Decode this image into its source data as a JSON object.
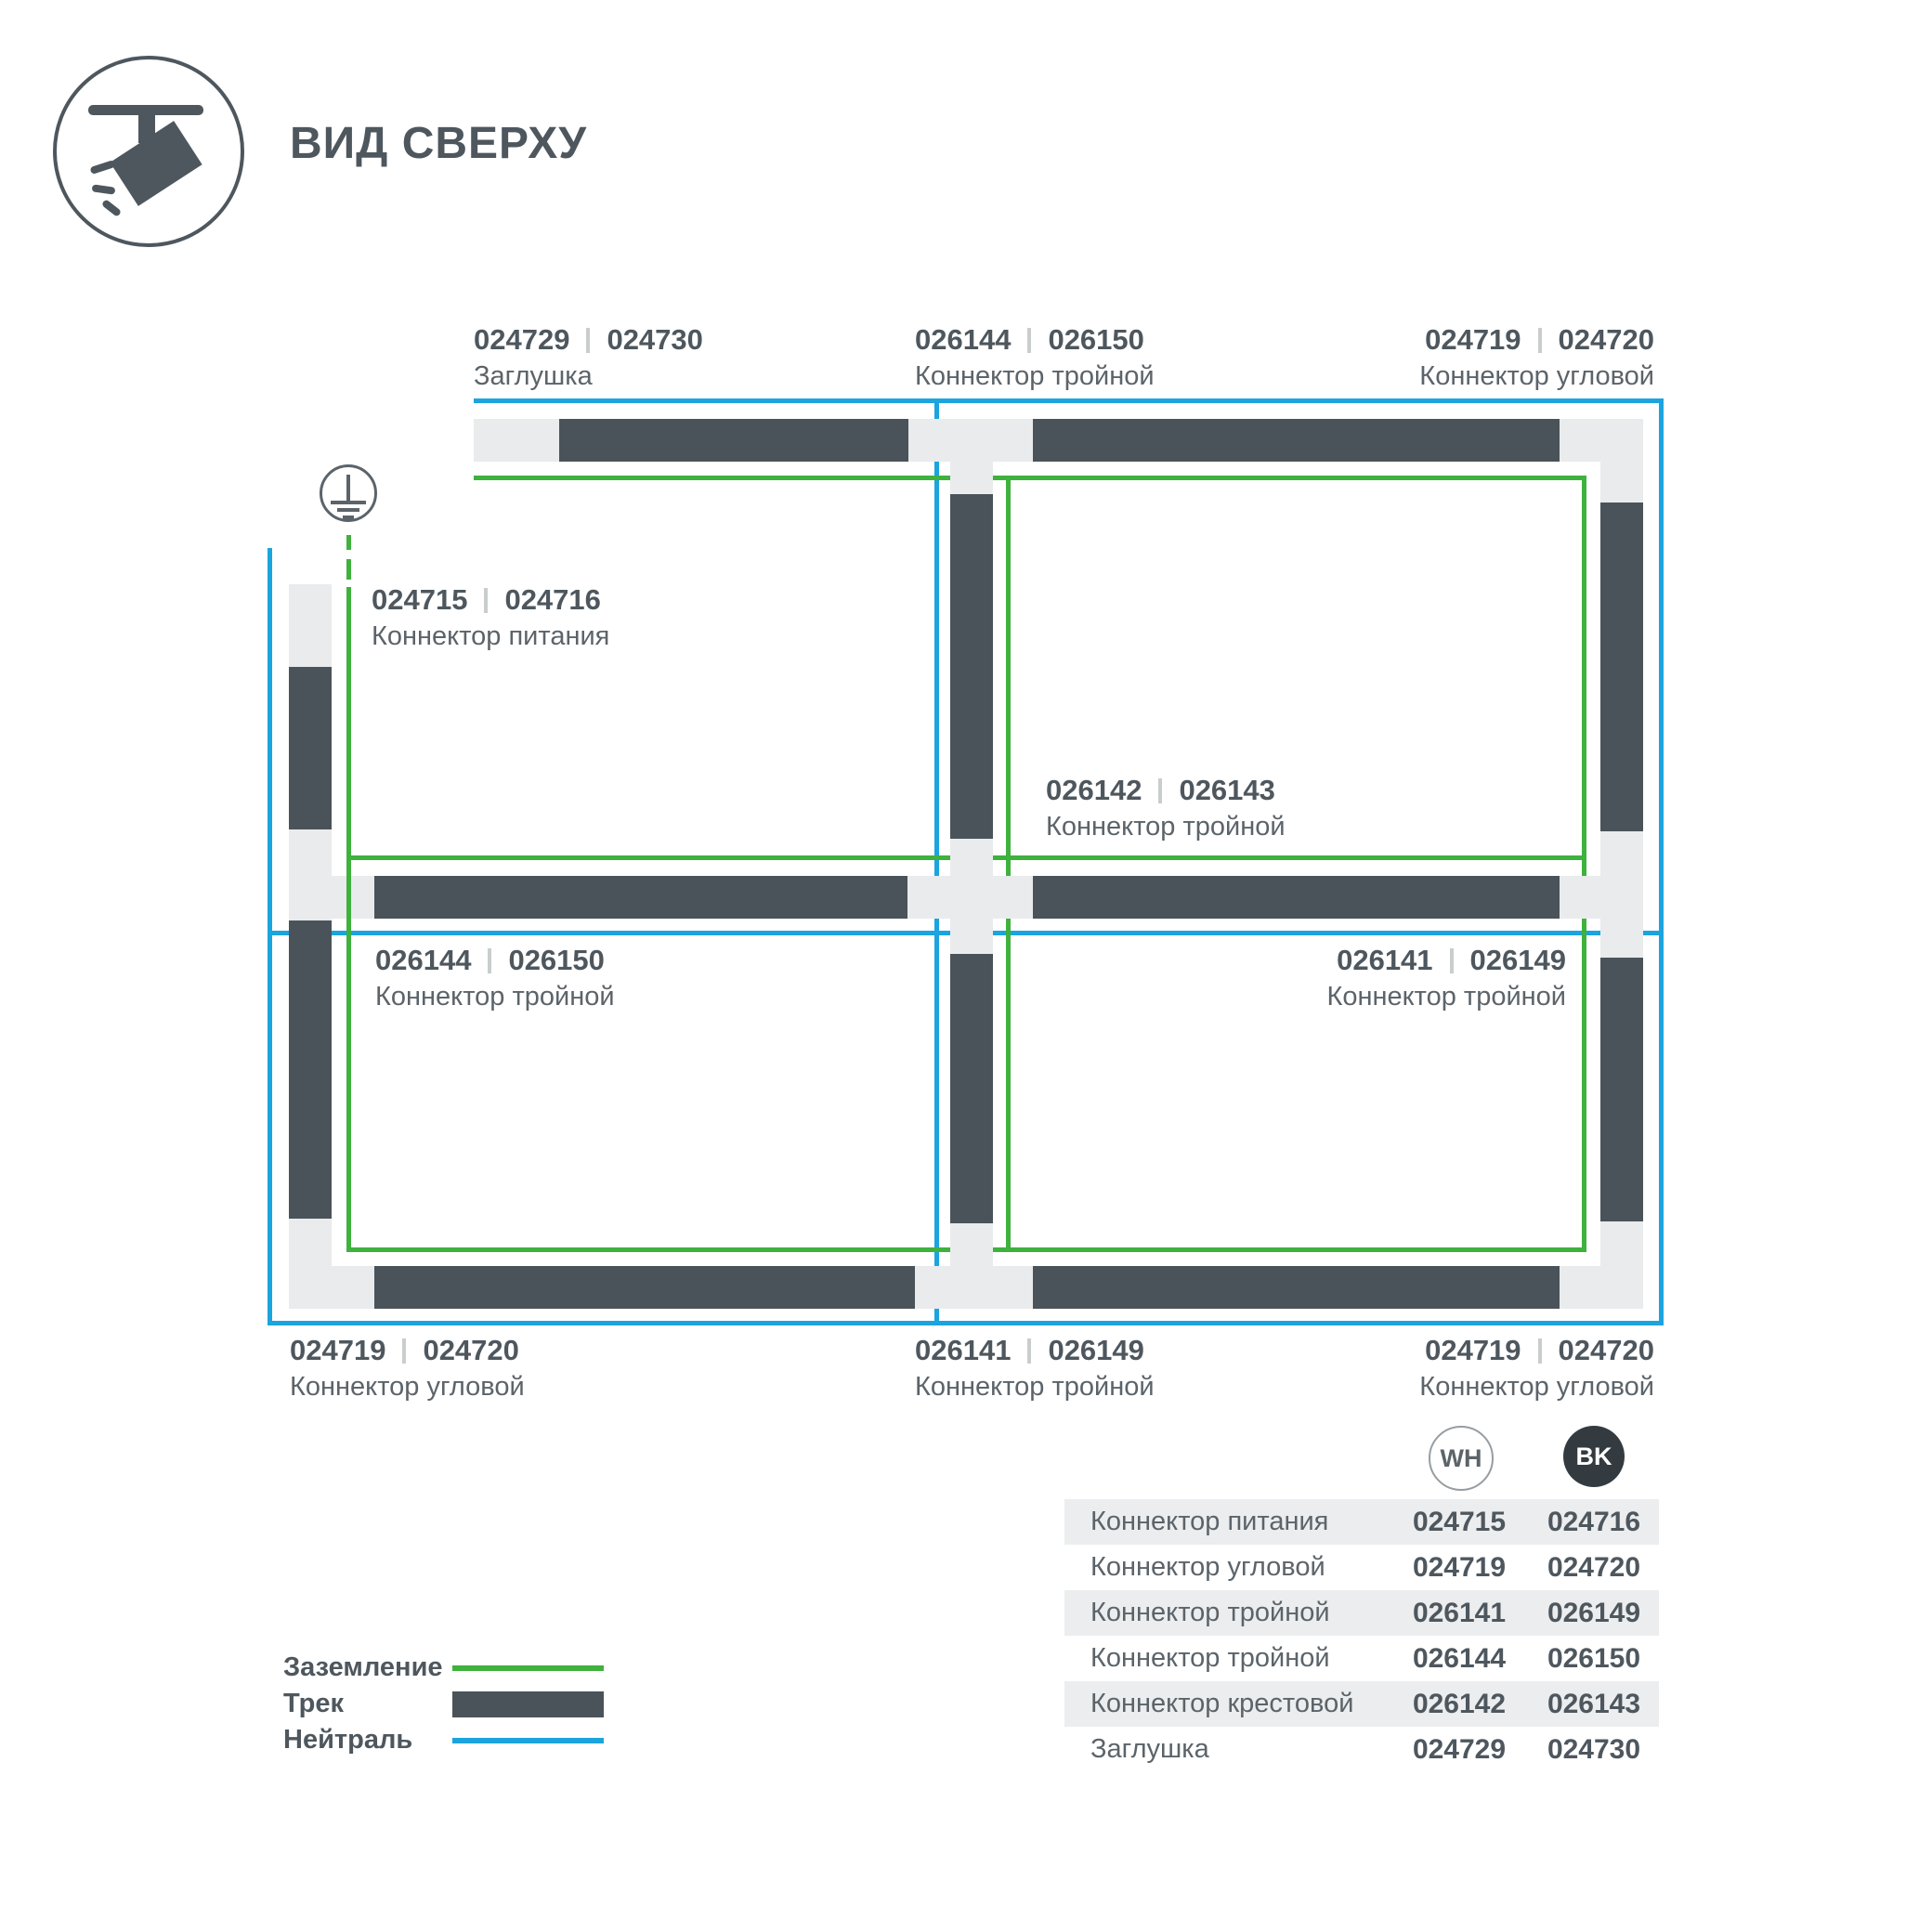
{
  "title": "ВИД СВЕРХУ",
  "colors": {
    "ground": "#3fb13d",
    "neutral": "#1ba4de",
    "track": "#4a535a",
    "base": "#e9ebec",
    "text1": "#4e575e",
    "text2": "#5c646a"
  },
  "legend": {
    "items": [
      {
        "label": "Заземление",
        "swatch": "ground-line"
      },
      {
        "label": "Трек",
        "swatch": "track-bar"
      },
      {
        "label": "Нейтраль",
        "swatch": "neutral-line"
      }
    ]
  },
  "callouts": [
    {
      "num1": "024729",
      "num2": "024730",
      "name": "Заглушка"
    },
    {
      "num1": "026144",
      "num2": "026150",
      "name": "Коннектор тройной"
    },
    {
      "num1": "024719",
      "num2": "024720",
      "name": "Коннектор угловой"
    },
    {
      "num1": "024715",
      "num2": "024716",
      "name": "Коннектор питания"
    },
    {
      "num1": "026142",
      "num2": "026143",
      "name": "Коннектор тройной"
    },
    {
      "num1": "026144",
      "num2": "026150",
      "name": "Коннектор тройной"
    },
    {
      "num1": "026141",
      "num2": "026149",
      "name": "Коннектор тройной"
    },
    {
      "num1": "024719",
      "num2": "024720",
      "name": "Коннектор угловой"
    },
    {
      "num1": "026141",
      "num2": "026149",
      "name": "Коннектор тройной"
    },
    {
      "num1": "024719",
      "num2": "024720",
      "name": "Коннектор угловой"
    }
  ],
  "badges": {
    "wh": "WH",
    "bk": "BK"
  },
  "table": {
    "rows": [
      {
        "name": "Коннектор питания",
        "wh": "024715",
        "bk": "024716"
      },
      {
        "name": "Коннектор угловой",
        "wh": "024719",
        "bk": "024720"
      },
      {
        "name": "Коннектор тройной",
        "wh": "026141",
        "bk": "026149"
      },
      {
        "name": "Коннектор тройной",
        "wh": "026144",
        "bk": "026150"
      },
      {
        "name": "Коннектор крестовой",
        "wh": "026142",
        "bk": "026143"
      },
      {
        "name": "Заглушка",
        "wh": "024729",
        "bk": "024730"
      }
    ]
  }
}
